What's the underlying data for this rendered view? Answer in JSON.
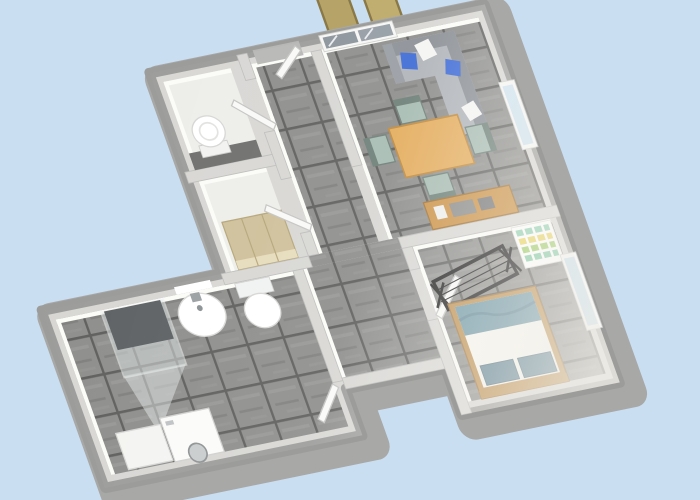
{
  "scene": {
    "description": "3D aerial oblique rendering of an apartment floor plan",
    "background_color": "#c9def1",
    "view": "rotated bird's-eye 3D floor plan, no text labels"
  },
  "palette": {
    "background": "#c9def1",
    "wall_top": "#d8d7d4",
    "wall_outer_band": "#a8a8a6",
    "inner_wall_face": "#fbfbf8",
    "tile_floor": "#8e8e8c",
    "tile_grout": "#5f5f5d",
    "light_floor": "#ededea",
    "table_wood": "#e4ad5e",
    "sideboard_wood": "#cb9145",
    "bed_frame_wood": "#bd8f4f",
    "sofa_seat": "#b0b4b9",
    "sofa_back": "#8b9096",
    "cushion_blue": "#3e6bd6",
    "cushion_white": "#f4f4f2",
    "chair_teal": "#a7bcb2",
    "bed_textile_teal": "#6d96a4",
    "window_glass": "#cfe3ef",
    "french_door_glass": "#8b939b",
    "pergola_beam": "#b5a367",
    "drying_rack": "#1d1d1d",
    "wardrobe": "#cfc09a",
    "shower_tray": "#5d6164"
  },
  "rooms": [
    {
      "id": "living-room",
      "floor": "gray tile",
      "features": [
        "french glass doors on top wall",
        "window on right wall"
      ],
      "furniture": [
        "gray corner sofa with blue and white cushions",
        "light wood dining table",
        "four teal chairs",
        "wooden sideboard with gray objects"
      ]
    },
    {
      "id": "hallway",
      "floor": "gray tile",
      "features": [
        "entrance doorway with open white door leaf",
        "open interior doors"
      ]
    },
    {
      "id": "wc",
      "floor": "light with dark tiled strip",
      "furniture": [
        "toilet"
      ]
    },
    {
      "id": "storage-closet",
      "floor": "light",
      "furniture": [
        "tan wardrobe"
      ]
    },
    {
      "id": "bathroom",
      "floor": "gray tile",
      "furniture": [
        "glass shower cabin",
        "washbasin with faucet",
        "toilet",
        "washing machine",
        "white cabinet"
      ],
      "features": [
        "wall mirror",
        "open door from hallway"
      ]
    },
    {
      "id": "bedroom",
      "floor": "gray tile",
      "features": [
        "window on right wall",
        "open door from hallway"
      ],
      "furniture": [
        "double bed with wood frame, white duvet, teal blanket and two teal pillows",
        "black laundry drying rack",
        "white shelf with colorful books"
      ]
    }
  ],
  "exterior": {
    "features": [
      "two slanted wooden pergola beams outside the top wall"
    ]
  }
}
